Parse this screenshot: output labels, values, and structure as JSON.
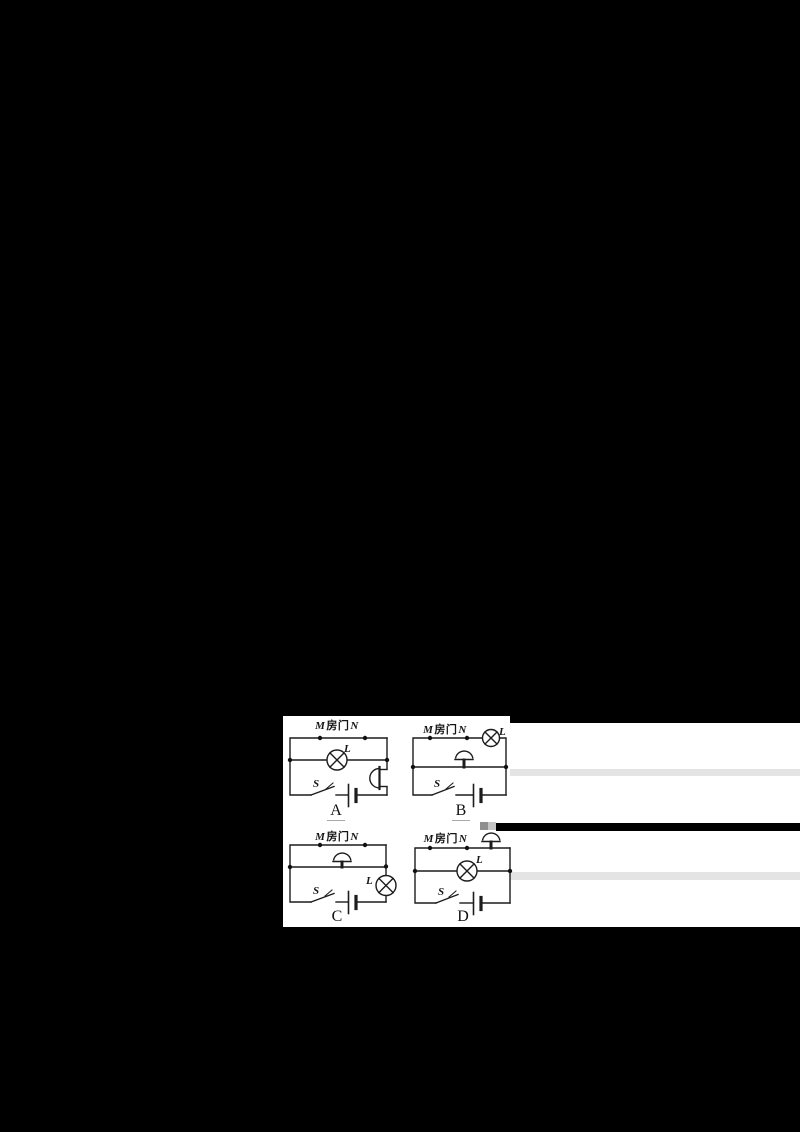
{
  "page": {
    "background": "#000000",
    "panel_color": "#ffffff",
    "ink_color": "#1c1c1c"
  },
  "figure": {
    "kind": "electric-circuit-multiple-choice",
    "door_label": {
      "m": "M",
      "door": "房门",
      "n": "N"
    },
    "lamp_label": "L",
    "switch_label": "S",
    "options": [
      {
        "letter": "A",
        "underlined": true,
        "arrangement": "lamp L on middle branch; bell on right-side branch; switch S and battery on bottom branch"
      },
      {
        "letter": "B",
        "underlined": true,
        "arrangement": "lamp L at top-right corner; bell on middle branch; switch S and battery on bottom branch"
      },
      {
        "letter": "C",
        "underlined": false,
        "arrangement": "bell on middle branch; lamp L on right-side branch; switch S and battery on bottom branch"
      },
      {
        "letter": "D",
        "underlined": false,
        "arrangement": "bell at top-right corner; lamp L on middle branch; switch S and battery on bottom branch"
      }
    ],
    "artifact_colors": {
      "stripe": "#e4e4e4",
      "bar": "#000000",
      "smudge_dark": "#8f8f8f",
      "smudge_light": "#c6c6c6",
      "underline": "#aaaaaa"
    }
  }
}
